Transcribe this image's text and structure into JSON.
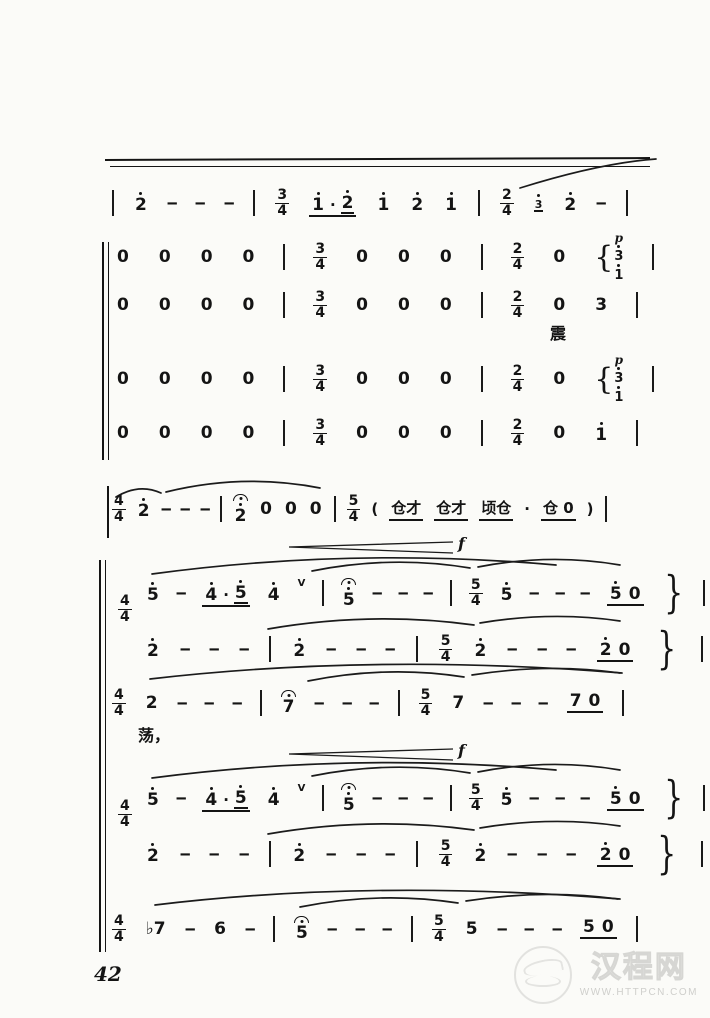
{
  "page": {
    "number": "42"
  },
  "watermark": {
    "site_name": "汉程网",
    "site_url": "WWW.HTTPCN.COM"
  },
  "lyrics": {
    "l1": "震",
    "l2": "荡，"
  },
  "dynamics": {
    "f1": "f",
    "f2": "f"
  },
  "colors": {
    "ink": "#141414",
    "paper": "#fbfbf8",
    "watermark": "#d6d6d3"
  },
  "music": {
    "rows": {
      "r1": [
        {
          "t": "bar"
        },
        {
          "t": "n",
          "d": "2",
          "da": 1
        },
        {
          "t": "dash"
        },
        {
          "t": "dash"
        },
        {
          "t": "dash"
        },
        {
          "t": "bar"
        },
        {
          "t": "ts",
          "n": "3",
          "d": "4"
        },
        {
          "t": "grp",
          "u": 1,
          "items": [
            {
              "t": "n",
              "d": "1",
              "da": 1
            },
            {
              "t": "txt",
              "s": "·"
            },
            {
              "t": "n",
              "d": "2",
              "da": 1,
              "u": 1
            }
          ]
        },
        {
          "t": "n",
          "d": "1",
          "da": 1
        },
        {
          "t": "n",
          "d": "2",
          "da": 1
        },
        {
          "t": "n",
          "d": "1",
          "da": 1
        },
        {
          "t": "bar"
        },
        {
          "t": "ts",
          "n": "2",
          "d": "4"
        },
        {
          "t": "n",
          "d": "3",
          "da": 1,
          "g": 1,
          "u": 1
        },
        {
          "t": "n",
          "d": "2",
          "da": 1
        },
        {
          "t": "dash"
        },
        {
          "t": "bar"
        }
      ],
      "r2": [
        {
          "t": "n",
          "d": "0"
        },
        {
          "t": "n",
          "d": "0"
        },
        {
          "t": "n",
          "d": "0"
        },
        {
          "t": "n",
          "d": "0"
        },
        {
          "t": "bar"
        },
        {
          "t": "ts",
          "n": "3",
          "d": "4"
        },
        {
          "t": "n",
          "d": "0"
        },
        {
          "t": "n",
          "d": "0"
        },
        {
          "t": "n",
          "d": "0"
        },
        {
          "t": "bar"
        },
        {
          "t": "ts",
          "n": "2",
          "d": "4"
        },
        {
          "t": "n",
          "d": "0"
        },
        {
          "t": "chord",
          "p": "p",
          "notes": [
            {
              "d": "3",
              "da": 1
            },
            {
              "d": "1",
              "da": 1
            }
          ]
        },
        {
          "t": "bar"
        }
      ],
      "r3": [
        {
          "t": "n",
          "d": "0"
        },
        {
          "t": "n",
          "d": "0"
        },
        {
          "t": "n",
          "d": "0"
        },
        {
          "t": "n",
          "d": "0"
        },
        {
          "t": "bar"
        },
        {
          "t": "ts",
          "n": "3",
          "d": "4"
        },
        {
          "t": "n",
          "d": "0"
        },
        {
          "t": "n",
          "d": "0"
        },
        {
          "t": "n",
          "d": "0"
        },
        {
          "t": "bar"
        },
        {
          "t": "ts",
          "n": "2",
          "d": "4"
        },
        {
          "t": "n",
          "d": "0"
        },
        {
          "t": "n",
          "d": "3"
        },
        {
          "t": "bar"
        }
      ],
      "r4": [
        {
          "t": "n",
          "d": "0"
        },
        {
          "t": "n",
          "d": "0"
        },
        {
          "t": "n",
          "d": "0"
        },
        {
          "t": "n",
          "d": "0"
        },
        {
          "t": "bar"
        },
        {
          "t": "ts",
          "n": "3",
          "d": "4"
        },
        {
          "t": "n",
          "d": "0"
        },
        {
          "t": "n",
          "d": "0"
        },
        {
          "t": "n",
          "d": "0"
        },
        {
          "t": "bar"
        },
        {
          "t": "ts",
          "n": "2",
          "d": "4"
        },
        {
          "t": "n",
          "d": "0"
        },
        {
          "t": "chord",
          "p": "p",
          "notes": [
            {
              "d": "3",
              "da": 1
            },
            {
              "d": "1",
              "da": 1
            }
          ]
        },
        {
          "t": "bar"
        }
      ],
      "r5": [
        {
          "t": "n",
          "d": "0"
        },
        {
          "t": "n",
          "d": "0"
        },
        {
          "t": "n",
          "d": "0"
        },
        {
          "t": "n",
          "d": "0"
        },
        {
          "t": "bar"
        },
        {
          "t": "ts",
          "n": "3",
          "d": "4"
        },
        {
          "t": "n",
          "d": "0"
        },
        {
          "t": "n",
          "d": "0"
        },
        {
          "t": "n",
          "d": "0"
        },
        {
          "t": "bar"
        },
        {
          "t": "ts",
          "n": "2",
          "d": "4"
        },
        {
          "t": "n",
          "d": "0"
        },
        {
          "t": "n",
          "d": "1",
          "da": 1
        },
        {
          "t": "bar"
        }
      ],
      "rA": [
        {
          "t": "ts",
          "n": "4",
          "d": "4"
        },
        {
          "t": "n",
          "d": "2",
          "da": 1
        },
        {
          "t": "dash"
        },
        {
          "t": "dash"
        },
        {
          "t": "dash"
        },
        {
          "t": "bar"
        },
        {
          "t": "n",
          "d": "2",
          "da": 1,
          "fer": 1
        },
        {
          "t": "n",
          "d": "0"
        },
        {
          "t": "n",
          "d": "0"
        },
        {
          "t": "n",
          "d": "0"
        },
        {
          "t": "bar"
        },
        {
          "t": "ts",
          "n": "5",
          "d": "4"
        },
        {
          "t": "txt",
          "s": "("
        },
        {
          "t": "grp",
          "u": 1,
          "items": [
            {
              "t": "txt",
              "s": "仓才"
            }
          ]
        },
        {
          "t": "grp",
          "u": 1,
          "items": [
            {
              "t": "txt",
              "s": "仓才"
            }
          ]
        },
        {
          "t": "grp",
          "u": 1,
          "items": [
            {
              "t": "txt",
              "s": "顷仓"
            }
          ]
        },
        {
          "t": "txt",
          "s": "·"
        },
        {
          "t": "grp",
          "u": 1,
          "items": [
            {
              "t": "txt",
              "s": "仓 0"
            }
          ]
        },
        {
          "t": "txt",
          "s": ")"
        },
        {
          "t": "bar"
        }
      ],
      "tsB": [
        {
          "t": "ts",
          "n": "4",
          "d": "4"
        }
      ],
      "tsD": [
        {
          "t": "ts",
          "n": "4",
          "d": "4"
        }
      ],
      "rB1": [
        {
          "t": "n",
          "d": "5",
          "da": 1
        },
        {
          "t": "dash"
        },
        {
          "t": "grp",
          "u": 1,
          "items": [
            {
              "t": "n",
              "d": "4",
              "da": 1
            },
            {
              "t": "txt",
              "s": "·"
            },
            {
              "t": "n",
              "d": "5",
              "da": 1,
              "u": 1
            }
          ]
        },
        {
          "t": "n",
          "d": "4",
          "da": 1
        },
        {
          "t": "breath"
        },
        {
          "t": "bar"
        },
        {
          "t": "n",
          "d": "5",
          "da": 1,
          "fer": 1
        },
        {
          "t": "dash"
        },
        {
          "t": "dash"
        },
        {
          "t": "dash"
        },
        {
          "t": "bar"
        },
        {
          "t": "ts",
          "n": "5",
          "d": "4"
        },
        {
          "t": "n",
          "d": "5",
          "da": 1
        },
        {
          "t": "dash"
        },
        {
          "t": "dash"
        },
        {
          "t": "dash"
        },
        {
          "t": "grp",
          "u": 1,
          "items": [
            {
              "t": "n",
              "d": "5",
              "da": 1
            },
            {
              "t": "n",
              "d": "0"
            }
          ]
        },
        {
          "t": "brace"
        },
        {
          "t": "bar"
        }
      ],
      "rB2": [
        {
          "t": "n",
          "d": "2",
          "da": 1
        },
        {
          "t": "dash"
        },
        {
          "t": "dash"
        },
        {
          "t": "dash"
        },
        {
          "t": "bar"
        },
        {
          "t": "n",
          "d": "2",
          "da": 1
        },
        {
          "t": "dash"
        },
        {
          "t": "dash"
        },
        {
          "t": "dash"
        },
        {
          "t": "bar"
        },
        {
          "t": "ts",
          "n": "5",
          "d": "4"
        },
        {
          "t": "n",
          "d": "2",
          "da": 1
        },
        {
          "t": "dash"
        },
        {
          "t": "dash"
        },
        {
          "t": "dash"
        },
        {
          "t": "grp",
          "u": 1,
          "items": [
            {
              "t": "n",
              "d": "2",
              "da": 1
            },
            {
              "t": "n",
              "d": "0"
            }
          ]
        },
        {
          "t": "brace"
        },
        {
          "t": "bar"
        }
      ],
      "rC": [
        {
          "t": "ts",
          "n": "4",
          "d": "4"
        },
        {
          "t": "n",
          "d": "2"
        },
        {
          "t": "dash"
        },
        {
          "t": "dash"
        },
        {
          "t": "dash"
        },
        {
          "t": "bar"
        },
        {
          "t": "n",
          "d": "7",
          "fer": 1
        },
        {
          "t": "dash"
        },
        {
          "t": "dash"
        },
        {
          "t": "dash"
        },
        {
          "t": "bar"
        },
        {
          "t": "ts",
          "n": "5",
          "d": "4"
        },
        {
          "t": "n",
          "d": "7"
        },
        {
          "t": "dash"
        },
        {
          "t": "dash"
        },
        {
          "t": "dash"
        },
        {
          "t": "grp",
          "u": 1,
          "items": [
            {
              "t": "n",
              "d": "7"
            },
            {
              "t": "n",
              "d": "0"
            }
          ]
        },
        {
          "t": "bar"
        }
      ],
      "rD1": [
        {
          "t": "n",
          "d": "5",
          "da": 1
        },
        {
          "t": "dash"
        },
        {
          "t": "grp",
          "u": 1,
          "items": [
            {
              "t": "n",
              "d": "4",
              "da": 1
            },
            {
              "t": "txt",
              "s": "·"
            },
            {
              "t": "n",
              "d": "5",
              "da": 1,
              "u": 1
            }
          ]
        },
        {
          "t": "n",
          "d": "4",
          "da": 1
        },
        {
          "t": "breath"
        },
        {
          "t": "bar"
        },
        {
          "t": "n",
          "d": "5",
          "da": 1,
          "fer": 1
        },
        {
          "t": "dash"
        },
        {
          "t": "dash"
        },
        {
          "t": "dash"
        },
        {
          "t": "bar"
        },
        {
          "t": "ts",
          "n": "5",
          "d": "4"
        },
        {
          "t": "n",
          "d": "5",
          "da": 1
        },
        {
          "t": "dash"
        },
        {
          "t": "dash"
        },
        {
          "t": "dash"
        },
        {
          "t": "grp",
          "u": 1,
          "items": [
            {
              "t": "n",
              "d": "5",
              "da": 1
            },
            {
              "t": "n",
              "d": "0"
            }
          ]
        },
        {
          "t": "brace"
        },
        {
          "t": "bar"
        }
      ],
      "rD2": [
        {
          "t": "n",
          "d": "2",
          "da": 1
        },
        {
          "t": "dash"
        },
        {
          "t": "dash"
        },
        {
          "t": "dash"
        },
        {
          "t": "bar"
        },
        {
          "t": "n",
          "d": "2",
          "da": 1
        },
        {
          "t": "dash"
        },
        {
          "t": "dash"
        },
        {
          "t": "dash"
        },
        {
          "t": "bar"
        },
        {
          "t": "ts",
          "n": "5",
          "d": "4"
        },
        {
          "t": "n",
          "d": "2",
          "da": 1
        },
        {
          "t": "dash"
        },
        {
          "t": "dash"
        },
        {
          "t": "dash"
        },
        {
          "t": "grp",
          "u": 1,
          "items": [
            {
              "t": "n",
              "d": "2",
              "da": 1
            },
            {
              "t": "n",
              "d": "0"
            }
          ]
        },
        {
          "t": "brace"
        },
        {
          "t": "bar"
        }
      ],
      "rE": [
        {
          "t": "ts",
          "n": "4",
          "d": "4"
        },
        {
          "t": "n",
          "d": "7",
          "acc": "♭"
        },
        {
          "t": "dash"
        },
        {
          "t": "n",
          "d": "6"
        },
        {
          "t": "dash"
        },
        {
          "t": "bar"
        },
        {
          "t": "n",
          "d": "5",
          "fer": 1
        },
        {
          "t": "dash"
        },
        {
          "t": "dash"
        },
        {
          "t": "dash"
        },
        {
          "t": "bar"
        },
        {
          "t": "ts",
          "n": "5",
          "d": "4"
        },
        {
          "t": "n",
          "d": "5"
        },
        {
          "t": "dash"
        },
        {
          "t": "dash"
        },
        {
          "t": "dash"
        },
        {
          "t": "grp",
          "u": 1,
          "items": [
            {
              "t": "n",
              "d": "5"
            },
            {
              "t": "n",
              "d": "0"
            }
          ]
        },
        {
          "t": "bar"
        }
      ]
    }
  }
}
